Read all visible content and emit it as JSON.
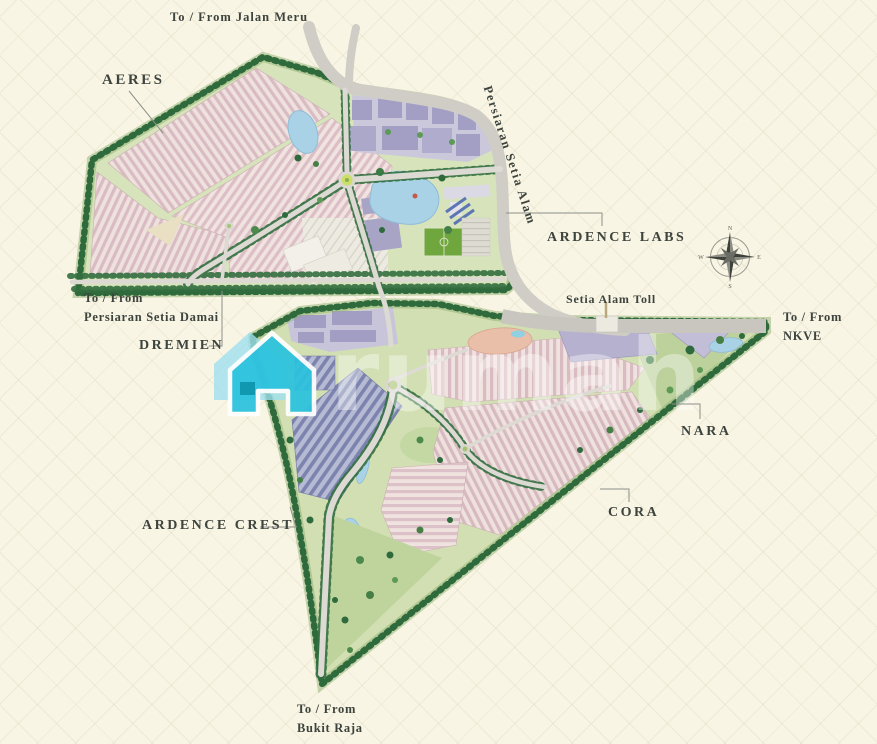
{
  "map_title": "Setia Alam township master plan",
  "roads": {
    "jalan_meru": "To / From Jalan Meru",
    "persiaran_setia_alam": "Persiaran Setia Alam",
    "setia_alam_toll": "Setia Alam Toll",
    "nkve_line1": "To / From",
    "nkve_line2": "NKVE",
    "setia_damai_line1": "To / From",
    "setia_damai_line2": "Persiaran Setia Damai",
    "bukit_raja_line1": "To / From",
    "bukit_raja_line2": "Bukit Raja"
  },
  "precincts": {
    "aeres": "AERES",
    "ardence_labs": "ARDENCE LABS",
    "dremien": "DREMIEN",
    "ardence_crest": "ARDENCE CREST",
    "nara": "NARA",
    "cora": "CORA"
  },
  "compass": {
    "north": "N",
    "east": "E",
    "south": "S",
    "west": "W"
  },
  "watermark": {
    "text": "rumah",
    "house_color": "#29c2de"
  },
  "colors": {
    "background": "#f8f5e4",
    "label_text": "#3d433d",
    "road": "#dcdad3",
    "highway": "#c8c6bf",
    "tree": "#336f40",
    "parcel_green": "#d7e3bb",
    "housing_pink": "#d9bcc3",
    "commercial_purple": "#a19dc3",
    "industrial_slate": "#7b83ae",
    "water": "#a9d2e6",
    "sports_field": "#6fa63e",
    "watermark_cyan": "#29c2de"
  }
}
